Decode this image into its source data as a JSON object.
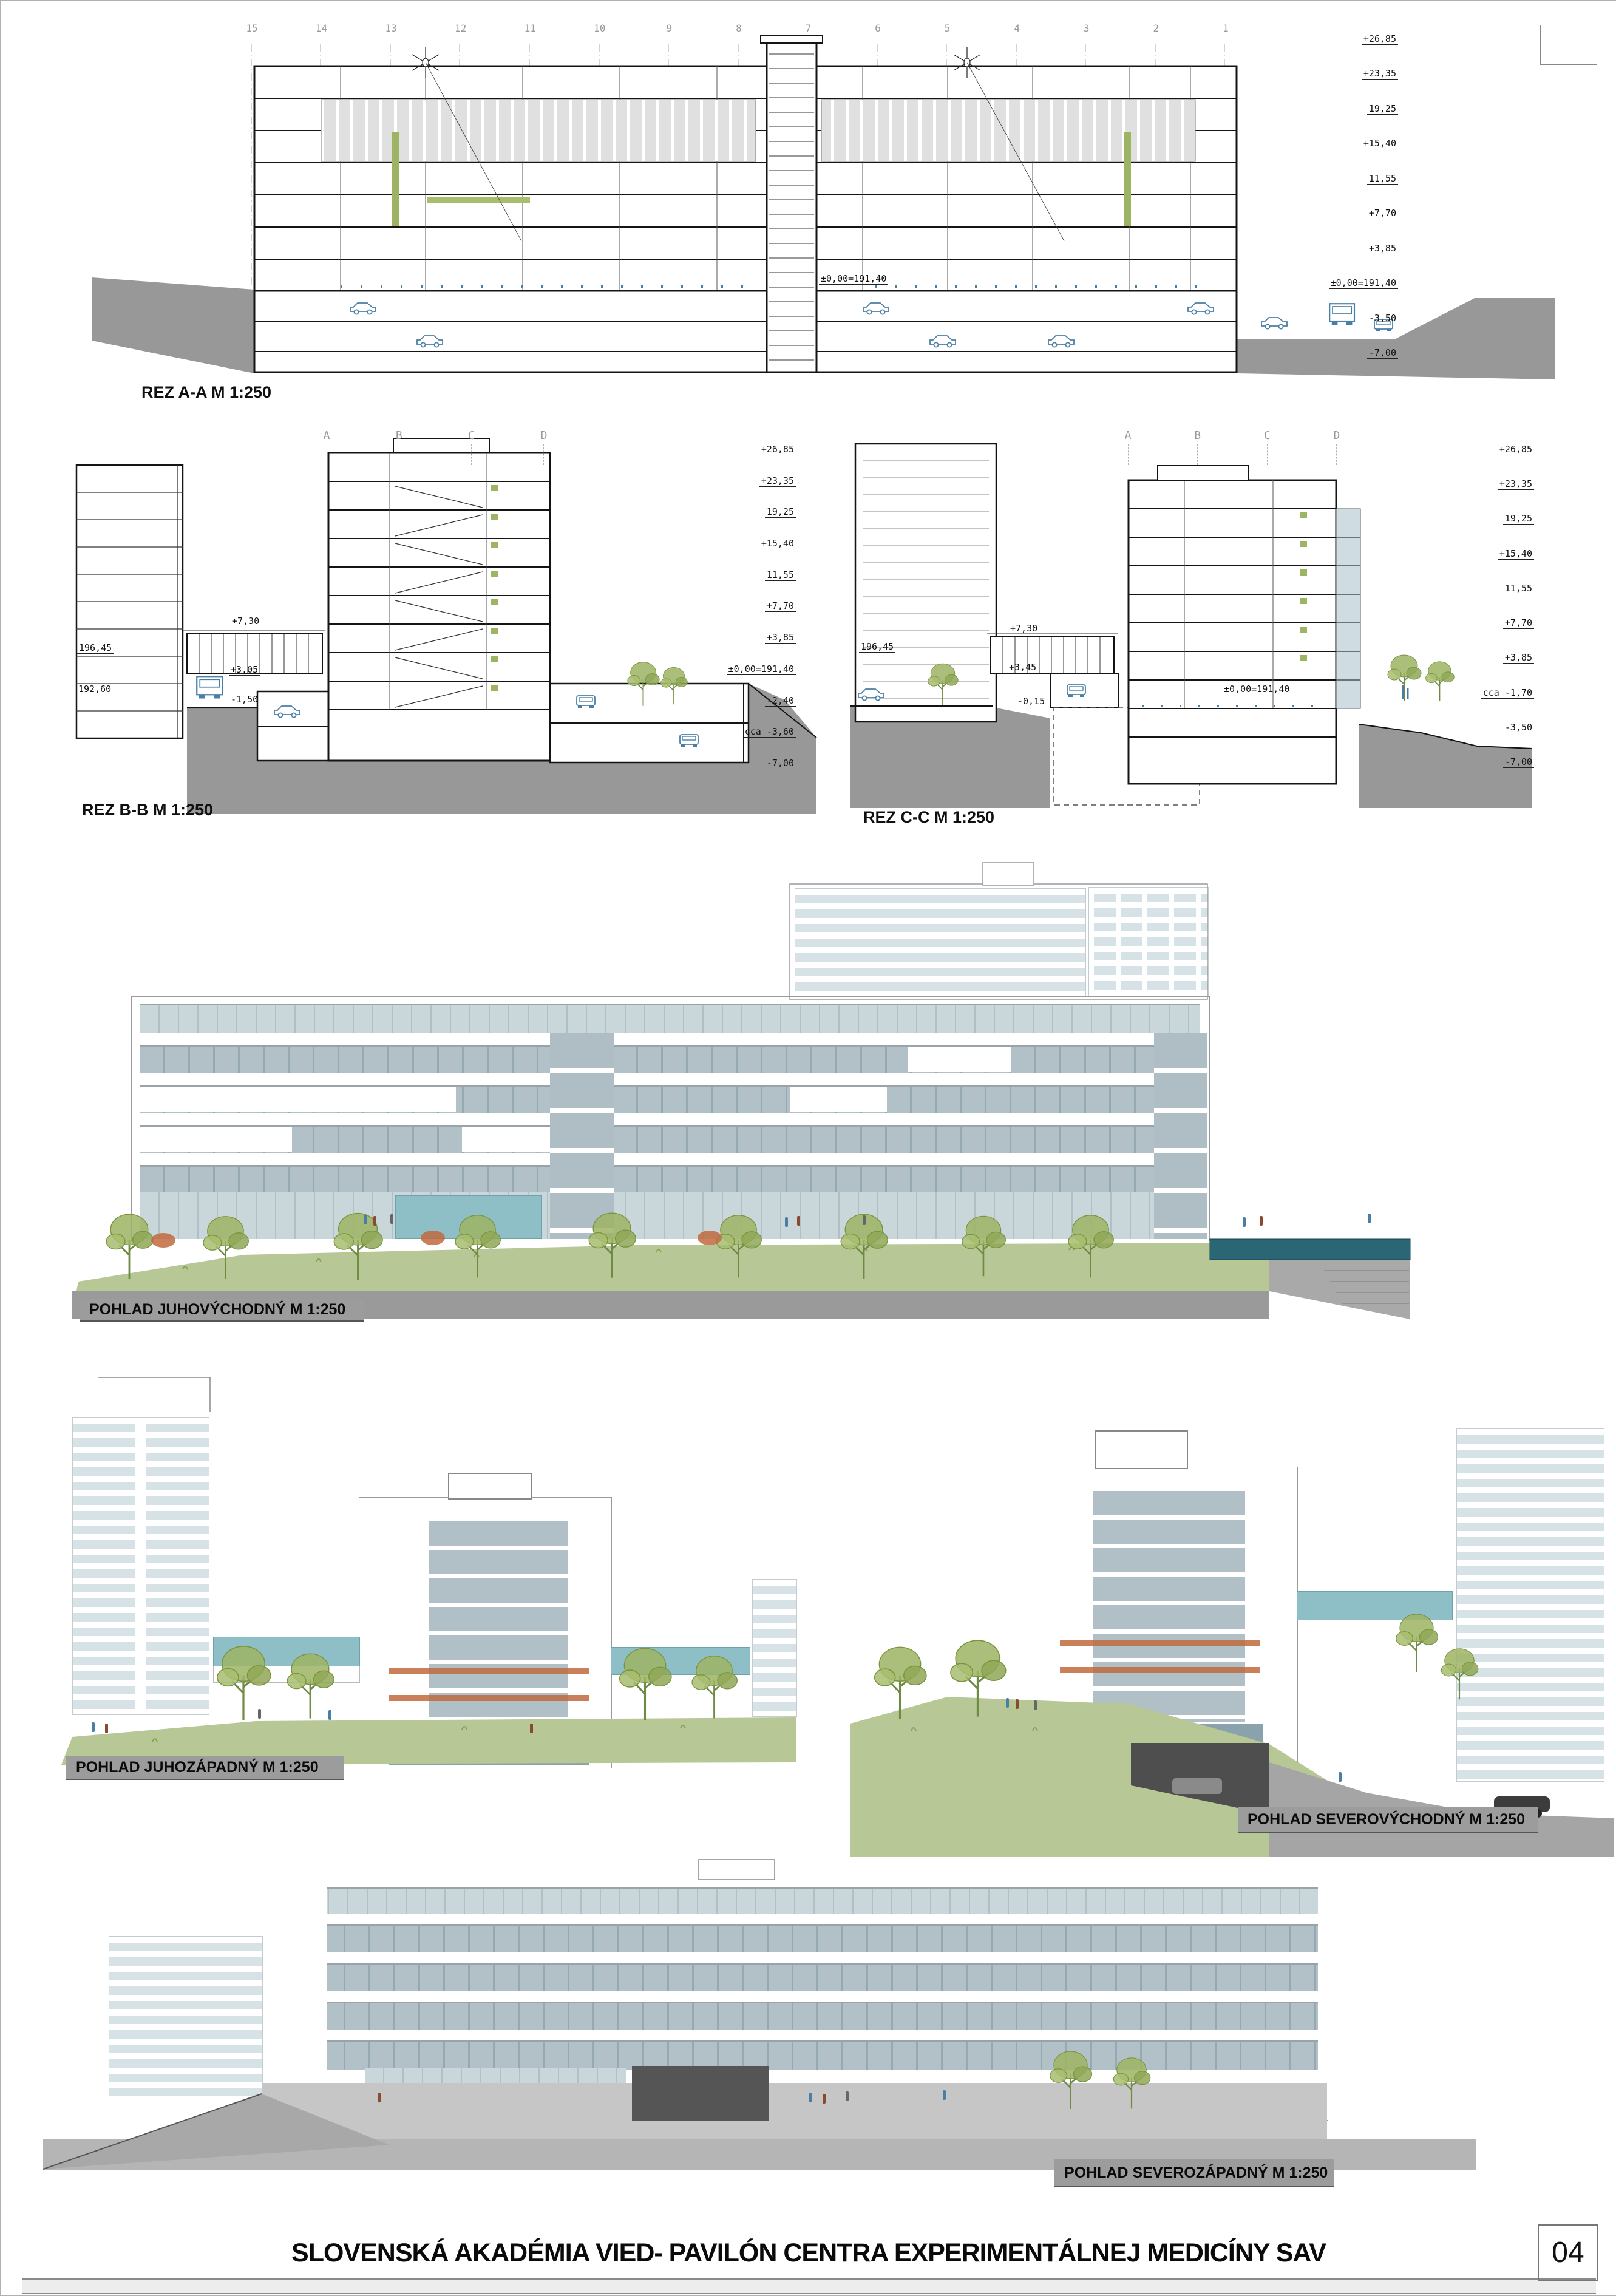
{
  "page": {
    "number": "04",
    "title": "SLOVENSKÁ AKADÉMIA VIED- PAVILÓN CENTRA EXPERIMENTÁLNEJ MEDICÍNY SAV"
  },
  "sections": {
    "rez_aa": {
      "label": "REZ A-A M 1:250",
      "grid_numbers": [
        "15",
        "14",
        "13",
        "12",
        "11",
        "10",
        "9",
        "8",
        "7",
        "6",
        "5",
        "4",
        "3",
        "2",
        "1"
      ],
      "levels_right": [
        "+26,85",
        "+23,35",
        "19,25",
        "+15,40",
        "11,55",
        "+7,70",
        "+3,85",
        "±0,00=191,40",
        "-3,50",
        "-7,00"
      ],
      "notes": {
        "ground": "±0,00=191,40"
      }
    },
    "rez_bb": {
      "label": "REZ B-B M 1:250",
      "grid_letters": [
        "A",
        "B",
        "C",
        "D"
      ],
      "levels_right": [
        "+26,85",
        "+23,35",
        "19,25",
        "+15,40",
        "11,55",
        "+7,70",
        "+3,85",
        "±0,00=191,40",
        "-2,40",
        "cca -3,60",
        "-7,00"
      ],
      "notes": {
        "n1": "196,45",
        "n2": "192,60",
        "n3": "+7,30",
        "n4": "+3,05",
        "n5": "-1,50"
      }
    },
    "rez_cc": {
      "label": "REZ C-C M 1:250",
      "grid_letters": [
        "A",
        "B",
        "C",
        "D"
      ],
      "levels_right": [
        "+26,85",
        "+23,35",
        "19,25",
        "+15,40",
        "11,55",
        "+7,70",
        "+3,85",
        "cca -1,70",
        "-3,50",
        "-7,00"
      ],
      "notes": {
        "n1": "196,45",
        "n2": "+7,30",
        "n3": "+3,45",
        "n4": "-0,15",
        "n5": "±0,00=191,40"
      }
    }
  },
  "elevations": {
    "southeast": {
      "label": "POHLAD JUHOVÝCHODNÝ M 1:250"
    },
    "southwest": {
      "label": "POHLAD JUHOZÁPADNÝ M 1:250"
    },
    "northeast": {
      "label": "POHLAD SEVEROVÝCHODNÝ M 1:250"
    },
    "northwest": {
      "label": "POHLAD SEVEROZÁPADNÝ  M 1:250"
    }
  },
  "colors": {
    "terrain": "#989898",
    "label_band": "#9c9c9c",
    "glass": "#a9bcc3",
    "glass_light": "#cdd9dd",
    "grass": "#b7c795",
    "tree": "#93aa5c",
    "canopy_teal": "#8fbfc6",
    "pool_teal": "#2a6673",
    "figure_blue": "#4a7fa5",
    "accent_red": "#c06a3e"
  }
}
